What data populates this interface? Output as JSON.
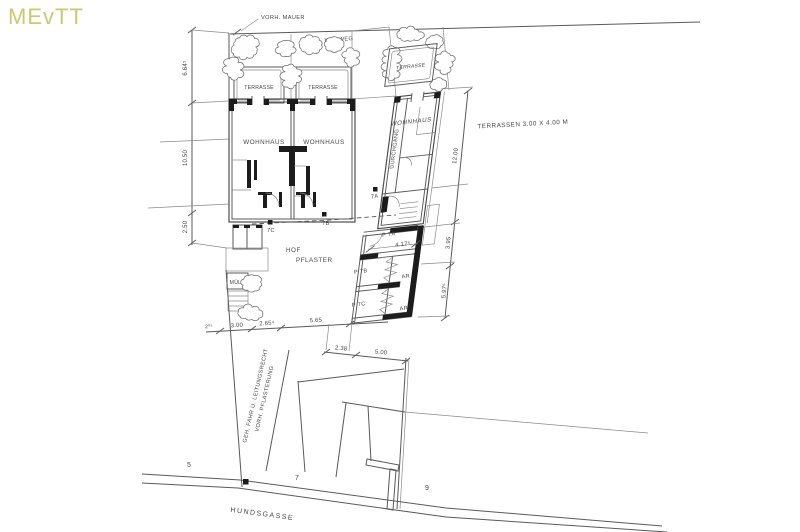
{
  "watermark": "MEvTT",
  "site": {
    "vorh_mauer": "VORH. MAUER",
    "kiesweg": "KIESWEG",
    "terrasse": "TERRASSE",
    "wohnhaus": "WOHNHAUS",
    "durchgang": "DURCHGANG",
    "hof_line1": "HOF",
    "hof_line2": "PFLASTER",
    "muell": "MÜLL",
    "terrassen_note": "TERRASSEN 3.00 X 4.00 M",
    "easement_line1": "GEH, FAHR U. LEITUNGSRECHT",
    "easement_line2": "VORH. PFLASTERUNG",
    "street": "HUNDSGASSE"
  },
  "units": {
    "p7a": "P 7A",
    "p7b": "P 7B",
    "p7c": "P 7C",
    "ar": "AR",
    "entrance_7a": "7A",
    "entrance_7b": "7B",
    "entrance_7c": "7C"
  },
  "plots": {
    "p5": "5",
    "p7": "7",
    "p9": "9"
  },
  "dims": {
    "left": [
      "6.64⁵",
      "10.50",
      "2.50"
    ],
    "hof": [
      "2⁰⁵",
      "3.00",
      "2.65⁴",
      "5.65"
    ],
    "lower": [
      "2.38",
      "5.00"
    ],
    "right": [
      "12.00",
      "3.95",
      "5.97⁵"
    ],
    "annex_width": "4.17⁵"
  },
  "colors": {
    "ink": "#474747",
    "line": "#5a5a5a",
    "watermark": "#c9c972"
  }
}
